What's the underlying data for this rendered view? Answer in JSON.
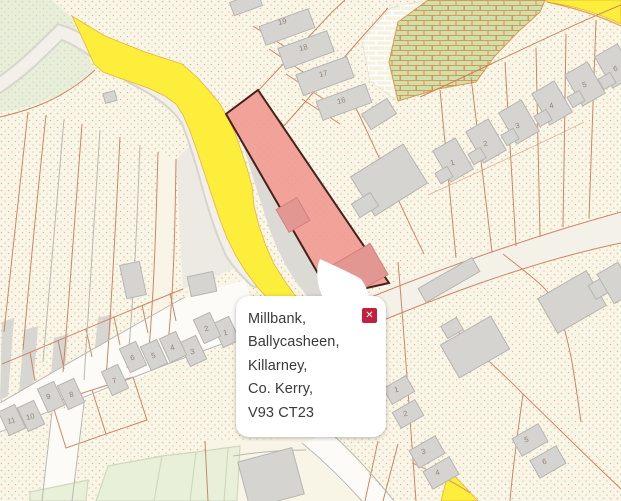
{
  "popup": {
    "address_lines": [
      "Millbank,",
      "Ballycasheen,",
      "Killarney,",
      "Co. Kerry,",
      "V93 CT23"
    ],
    "close_icon": "✕"
  },
  "map": {
    "kind": "cadastral-parcel-map",
    "highlighted_parcel": "Millbank, Ballycasheen",
    "building_numbers": [
      {
        "label": "19",
        "x": 283,
        "y": 24
      },
      {
        "label": "18",
        "x": 304,
        "y": 50
      },
      {
        "label": "17",
        "x": 324,
        "y": 76
      },
      {
        "label": "16",
        "x": 342,
        "y": 103
      },
      {
        "label": "1",
        "x": 453,
        "y": 165
      },
      {
        "label": "2",
        "x": 486,
        "y": 146
      },
      {
        "label": "3",
        "x": 518,
        "y": 128
      },
      {
        "label": "4",
        "x": 552,
        "y": 108
      },
      {
        "label": "5",
        "x": 585,
        "y": 87
      },
      {
        "label": "6",
        "x": 616,
        "y": 71
      },
      {
        "label": "1",
        "x": 397,
        "y": 392
      },
      {
        "label": "2",
        "x": 406,
        "y": 416
      },
      {
        "label": "3",
        "x": 424,
        "y": 454
      },
      {
        "label": "4",
        "x": 438,
        "y": 475
      },
      {
        "label": "5",
        "x": 527,
        "y": 442
      },
      {
        "label": "6",
        "x": 545,
        "y": 464
      },
      {
        "label": "1",
        "x": 226,
        "y": 335
      },
      {
        "label": "2",
        "x": 207,
        "y": 331
      },
      {
        "label": "3",
        "x": 193,
        "y": 354
      },
      {
        "label": "4",
        "x": 173,
        "y": 350
      },
      {
        "label": "5",
        "x": 154,
        "y": 358
      },
      {
        "label": "6",
        "x": 133,
        "y": 360
      },
      {
        "label": "7",
        "x": 115,
        "y": 383
      },
      {
        "label": "8",
        "x": 72,
        "y": 397
      },
      {
        "label": "9",
        "x": 49,
        "y": 399
      },
      {
        "label": "10",
        "x": 31,
        "y": 419
      },
      {
        "label": "11",
        "x": 12,
        "y": 423
      }
    ],
    "colors": {
      "background": "#faf6e7",
      "road_yellow": "#fcee3b",
      "parcel_line": "#c8825e",
      "highlight_fill": "#f09a92",
      "highlight_border": "#46221a",
      "woodland_fill": "#cde0ad",
      "building_fill": "#d6d4d1",
      "field_green": "#e9f0da",
      "popup_close_red": "#c2203e"
    }
  }
}
